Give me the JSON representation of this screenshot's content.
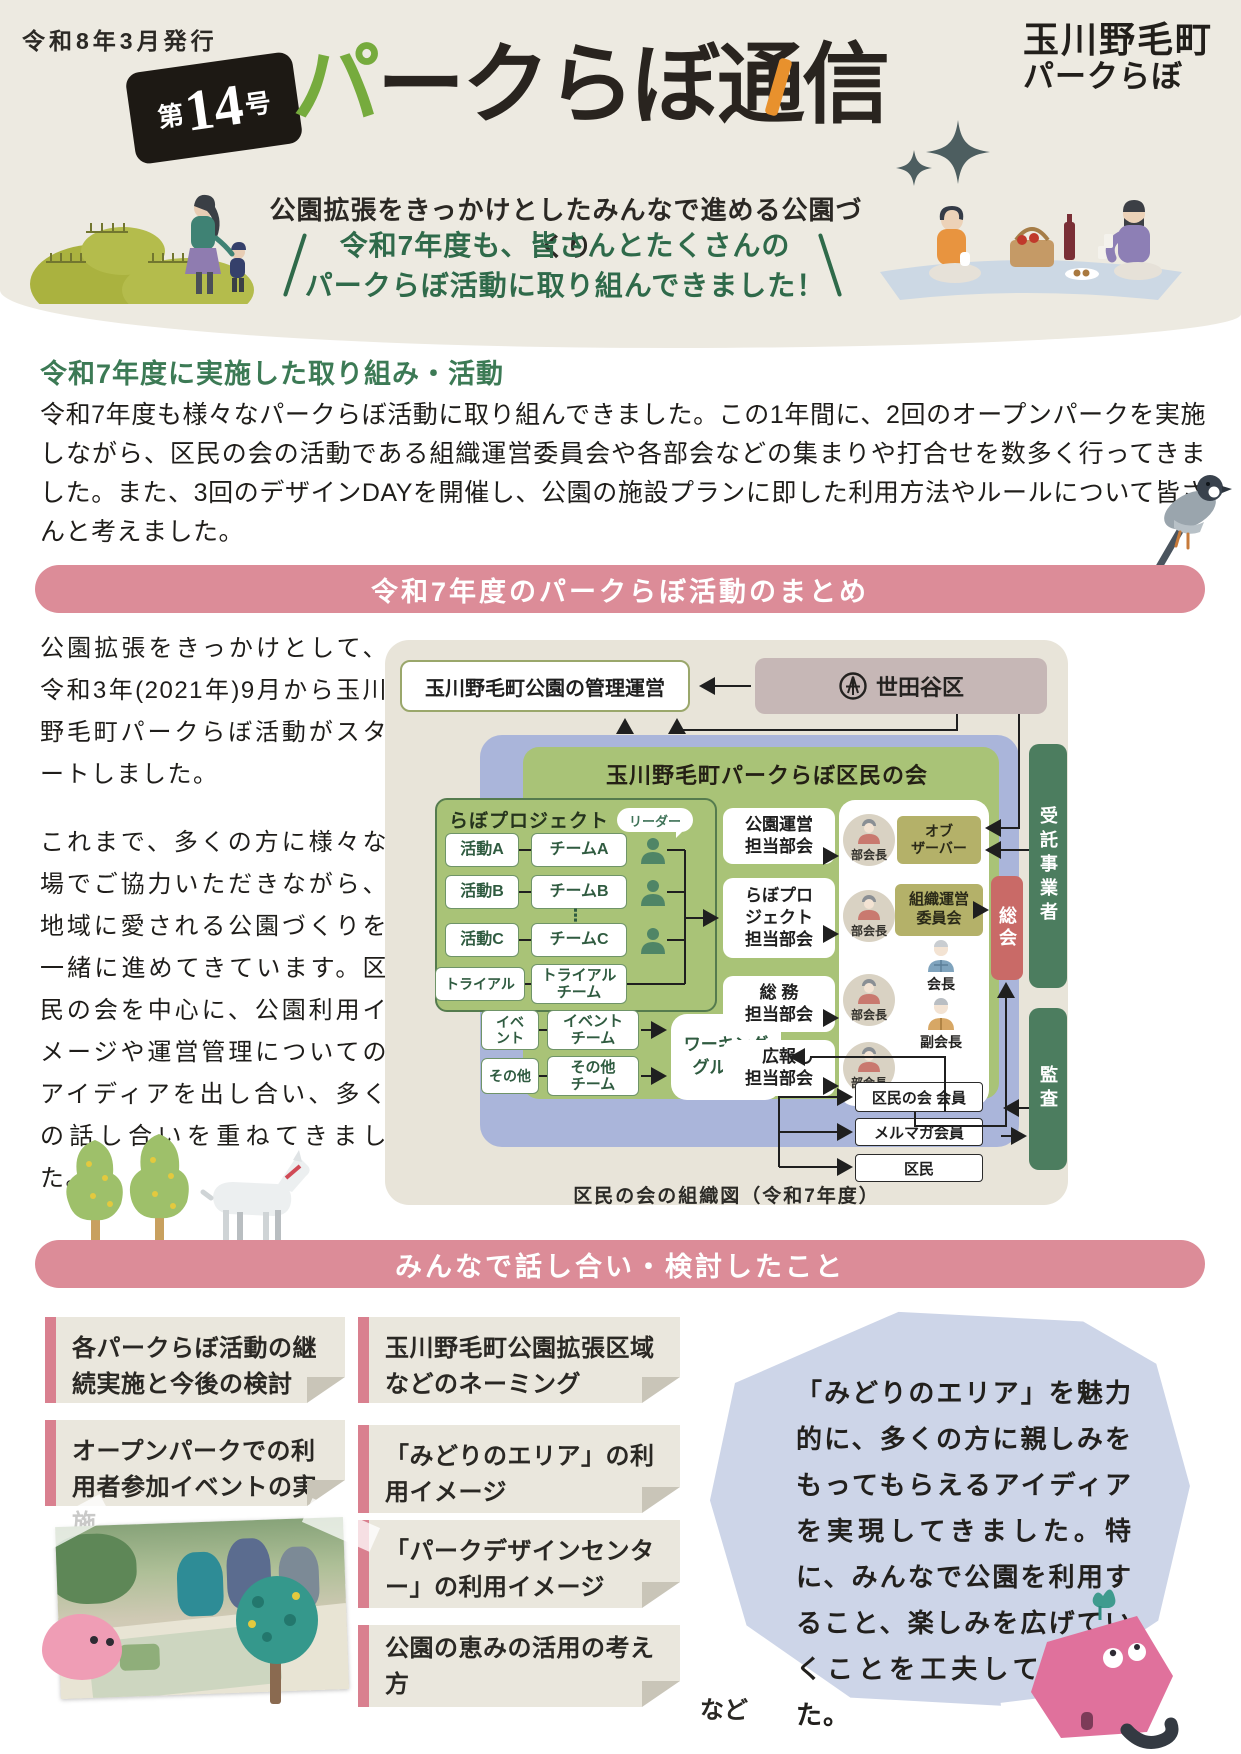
{
  "header": {
    "issue_date": "令和8年3月発行",
    "badge": {
      "prefix": "第",
      "number": "14",
      "suffix": "号"
    },
    "title_green": "パ",
    "title_black": "ークらぼ通",
    "title_last": "信",
    "logo_line1": "玉川野毛町",
    "logo_line2": "パークらぼ",
    "subtitle": "公園拡張をきっかけとしたみんなで進める公園づくり",
    "slogan_line1": "令和7年度も、皆さんとたくさんの",
    "slogan_line2": "パークらぼ活動に取り組んできました！"
  },
  "intro": {
    "heading": "令和7年度に実施した取り組み・活動",
    "body": "令和7年度も様々なパークらぼ活動に取り組んできました。この1年間に、2回のオープンパークを実施しながら、区民の会の活動である組織運営委員会や各部会などの集まりや打合せを数多く行ってきました。また、3回のデザインDAYを開催し、公園の施設プランに即した利用方法やルールについて皆さんと考えました。"
  },
  "summary": {
    "banner": "令和7年度のパークらぼ活動のまとめ",
    "para1": "公園拡張をきっかけとして、令和3年(2021年)9月から玉川野毛町パークらぼ活動がスタートしました。",
    "para2": "これまで、多くの方に様々な場でご協力いただきながら、地域に愛される公園づくりを一緒に進めてきています。区民の会を中心に、公園利用イメージや運営管理についてのアイディアを出し合い、多くの話し合いを重ねてきました。",
    "chart": {
      "management": "玉川野毛町公園の管理運営",
      "setagaya": "世田谷区",
      "council_title": "玉川野毛町パークらぼ区民の会",
      "labo_title": "らぼプロジェクト",
      "leader": "リーダー",
      "dots": "⋮",
      "labo_rows": [
        {
          "activity": "活動A",
          "team": "チームA"
        },
        {
          "activity": "活動B",
          "team": "チームB"
        },
        {
          "activity": "活動C",
          "team": "チームC"
        },
        {
          "activity": "トライアル",
          "team": "トライアル\nチーム"
        }
      ],
      "extra_rows": [
        {
          "activity": "イベ\nント",
          "team": "イベント\nチーム"
        },
        {
          "activity": "その他",
          "team": "その他\nチーム"
        }
      ],
      "working_group": "ワーキング\nグループ",
      "subcommittees": [
        "公園運営\n担当部会",
        "らぼプロ\nジェクト\n担当部会",
        "総 務\n担当部会",
        "広報\n担当部会"
      ],
      "bukaicho": "部会長",
      "observer": "オブ\nザーバー",
      "steering": "組織運営\n委員会",
      "general_meeting": "総会",
      "chairman": "会長",
      "vice_chairman": "副会長",
      "trustee": "受託事業者",
      "audit": "監査",
      "members": [
        "区民の会 会員",
        "メルマガ会員",
        "区民"
      ],
      "caption": "区民の会の組織図（令和7年度）"
    }
  },
  "discussion": {
    "banner": "みんなで話し合い・検討したこと",
    "notes": [
      "各パークらぼ活動の継続実施と今後の検討",
      "オープンパークでの利用者参加イベントの実施",
      "玉川野毛町公園拡張区域などのネーミング",
      "「みどりのエリア」の利用イメージ",
      "「パークデザインセンター」の利用イメージ",
      "公園の恵みの活用の考え方"
    ],
    "etc": "など",
    "bubble": "「みどりのエリア」を魅力的に、多くの方に親しみをもってもらえるアイディアを実現してきました。特に、みんなで公園を利用すること、楽しみを広げていくことを工夫してきました。"
  },
  "colors": {
    "banner_pink": "#dc8c98",
    "heading_green": "#3c7a55",
    "title_green": "#76ab3d",
    "title_orange": "#e8912d",
    "chart_blue": "#aab5da",
    "chart_green": "#a9c377",
    "dark_green": "#4c7d5f",
    "meeting_red": "#c96a67",
    "khaki": "#b4b169",
    "mauve": "#c6b7b6",
    "note_beige": "#eae7dd",
    "bubble_blue": "#cdd5e8"
  }
}
